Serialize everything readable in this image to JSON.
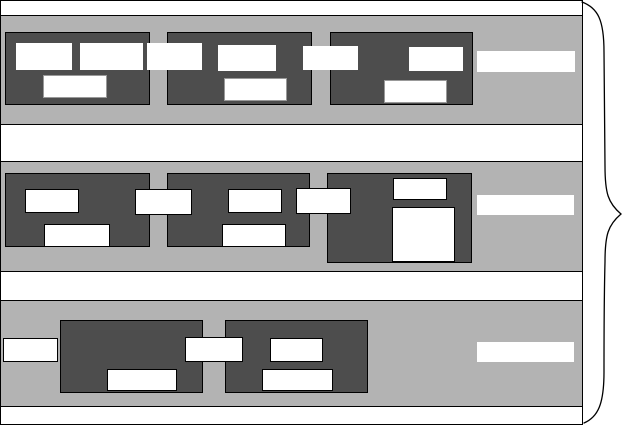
{
  "figure": {
    "kind": "wireframe-schematic",
    "canvas": {
      "width": 625,
      "height": 425
    },
    "frame": {
      "x": 0,
      "y": 0,
      "w": 583,
      "h": 425
    }
  },
  "colors": {
    "lane_fill": "#b3b3b3",
    "block_fill": "#4d4d4d",
    "slot_fill": "#ffffff",
    "line": "#000000",
    "muted_border": "#999999",
    "background": "#ffffff"
  },
  "lanes": [
    {
      "name": "lane-1",
      "x": 0,
      "y": 15,
      "w": 583,
      "h": 110
    },
    {
      "name": "lane-2",
      "x": 0,
      "y": 161,
      "w": 583,
      "h": 111
    },
    {
      "name": "lane-3",
      "x": 0,
      "y": 300,
      "w": 583,
      "h": 107
    }
  ],
  "dark_boxes": [
    {
      "name": "lane1-block-1",
      "x": 5,
      "y": 32,
      "w": 145,
      "h": 73
    },
    {
      "name": "lane1-block-2",
      "x": 167,
      "y": 32,
      "w": 145,
      "h": 73
    },
    {
      "name": "lane1-block-3",
      "x": 330,
      "y": 32,
      "w": 143,
      "h": 73
    },
    {
      "name": "lane2-block-1",
      "x": 5,
      "y": 173,
      "w": 145,
      "h": 74
    },
    {
      "name": "lane2-block-2",
      "x": 167,
      "y": 173,
      "w": 143,
      "h": 74
    },
    {
      "name": "lane2-block-3",
      "x": 327,
      "y": 173,
      "w": 145,
      "h": 90
    },
    {
      "name": "lane3-block-1",
      "x": 60,
      "y": 320,
      "w": 143,
      "h": 73
    },
    {
      "name": "lane3-block-2",
      "x": 225,
      "y": 320,
      "w": 143,
      "h": 73
    }
  ],
  "white_rects": [
    {
      "name": "lane1-b1-slot-a",
      "x": 16,
      "y": 43,
      "w": 56,
      "h": 27,
      "border": "none"
    },
    {
      "name": "lane1-b1-slot-b",
      "x": 80,
      "y": 43,
      "w": 63,
      "h": 27,
      "border": "none"
    },
    {
      "name": "lane1-b1-slot-c",
      "x": 43,
      "y": 75,
      "w": 64,
      "h": 23,
      "border": "muted"
    },
    {
      "name": "lane1-link-1",
      "x": 147,
      "y": 43,
      "w": 55,
      "h": 27,
      "border": "none"
    },
    {
      "name": "lane1-b2-slot-a",
      "x": 218,
      "y": 45,
      "w": 58,
      "h": 26,
      "border": "none"
    },
    {
      "name": "lane1-b2-slot-b",
      "x": 224,
      "y": 78,
      "w": 63,
      "h": 23,
      "border": "muted"
    },
    {
      "name": "lane1-link-2",
      "x": 303,
      "y": 46,
      "w": 55,
      "h": 24,
      "border": "none"
    },
    {
      "name": "lane1-b3-slot-a",
      "x": 409,
      "y": 47,
      "w": 54,
      "h": 24,
      "border": "none"
    },
    {
      "name": "lane1-b3-slot-b",
      "x": 384,
      "y": 80,
      "w": 63,
      "h": 23,
      "border": "muted"
    },
    {
      "name": "lane1-label-bar",
      "x": 477,
      "y": 51,
      "w": 98,
      "h": 21,
      "border": "none"
    },
    {
      "name": "lane2-b1-slot-a",
      "x": 25,
      "y": 189,
      "w": 54,
      "h": 24,
      "border": "black"
    },
    {
      "name": "lane2-b1-slot-b",
      "x": 44,
      "y": 224,
      "w": 66,
      "h": 23,
      "border": "black"
    },
    {
      "name": "lane2-link-1",
      "x": 135,
      "y": 189,
      "w": 57,
      "h": 26,
      "border": "black"
    },
    {
      "name": "lane2-b2-slot-a",
      "x": 228,
      "y": 189,
      "w": 54,
      "h": 24,
      "border": "black"
    },
    {
      "name": "lane2-b2-slot-b",
      "x": 222,
      "y": 224,
      "w": 64,
      "h": 23,
      "border": "black"
    },
    {
      "name": "lane2-link-2",
      "x": 296,
      "y": 188,
      "w": 55,
      "h": 26,
      "border": "black"
    },
    {
      "name": "lane2-b3-slot-a",
      "x": 393,
      "y": 178,
      "w": 54,
      "h": 22,
      "border": "black"
    },
    {
      "name": "lane2-b3-slot-b",
      "x": 392,
      "y": 207,
      "w": 63,
      "h": 55,
      "border": "black"
    },
    {
      "name": "lane2-label-bar",
      "x": 477,
      "y": 195,
      "w": 97,
      "h": 20,
      "border": "none"
    },
    {
      "name": "lane3-input-stub",
      "x": 3,
      "y": 338,
      "w": 55,
      "h": 24,
      "border": "black"
    },
    {
      "name": "lane3-b1-slot-a",
      "x": 107,
      "y": 369,
      "w": 70,
      "h": 22,
      "border": "black"
    },
    {
      "name": "lane3-link-1",
      "x": 185,
      "y": 337,
      "w": 58,
      "h": 25,
      "border": "black"
    },
    {
      "name": "lane3-b2-slot-a",
      "x": 270,
      "y": 338,
      "w": 53,
      "h": 24,
      "border": "black"
    },
    {
      "name": "lane3-b2-slot-b",
      "x": 262,
      "y": 369,
      "w": 71,
      "h": 22,
      "border": "black"
    },
    {
      "name": "lane3-label-bar",
      "x": 477,
      "y": 342,
      "w": 97,
      "h": 20,
      "border": "none"
    }
  ],
  "brace": {
    "path": "M582 2 C598 8 604 20 604 52 C604 92 605 130 605 166 C605 193 608 203 621 214 C608 225 605 235 605 262 C604 300 604 336 604 372 C604 404 598 417 584 423",
    "stroke_width": 1.3
  }
}
